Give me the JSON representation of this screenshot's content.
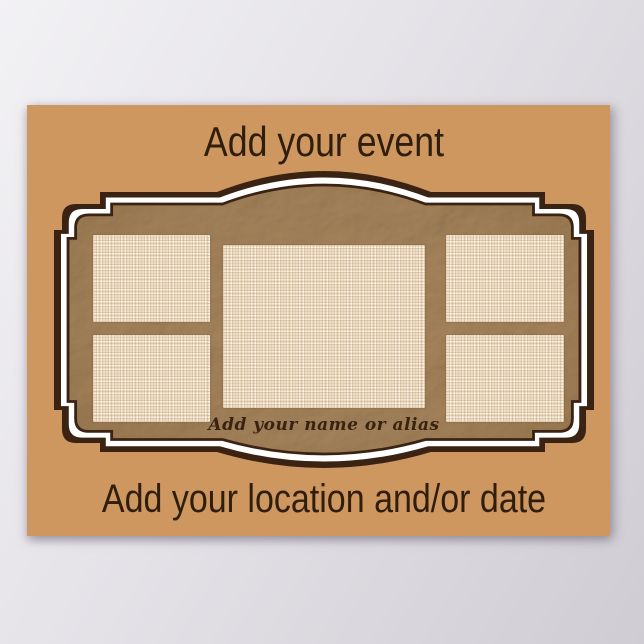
{
  "poster": {
    "event_placeholder": "Add your event",
    "location_placeholder": "Add your location and/or date",
    "name_placeholder": "Add your name or alias",
    "colors": {
      "page_background": "#dfdde2",
      "poster_background": "#cf9760",
      "frame_dark_brown": "#3a2312",
      "frame_white_band": "#ffffff",
      "kraft_paper": "#a9875e",
      "burlap_placeholder": "#ecdcc2",
      "placeholder_text": "#301e0d"
    },
    "photo_slots": [
      {
        "position": "left-top"
      },
      {
        "position": "left-bottom"
      },
      {
        "position": "center"
      },
      {
        "position": "right-top"
      },
      {
        "position": "right-bottom"
      }
    ]
  }
}
